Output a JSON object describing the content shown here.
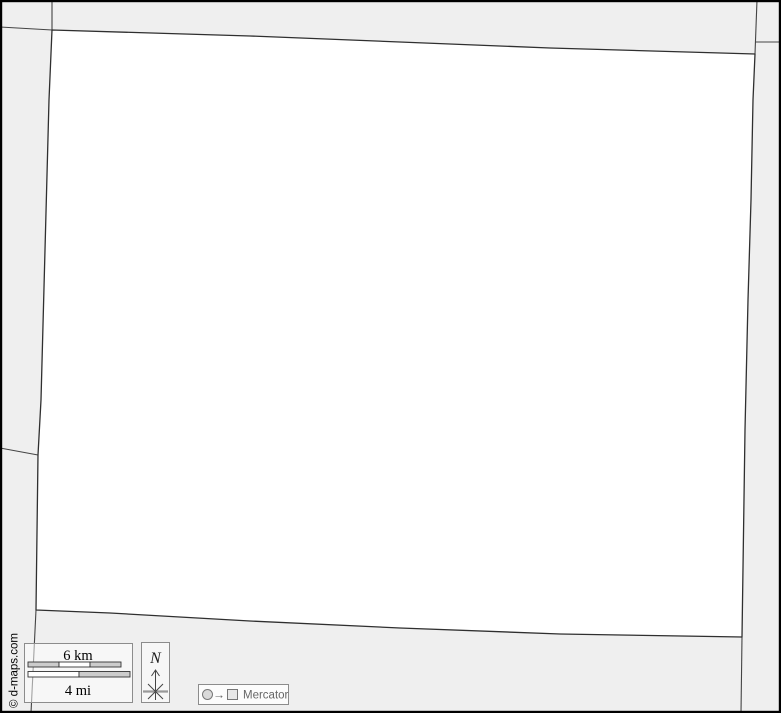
{
  "map": {
    "copyright": "© d-maps.com",
    "scale_bar": {
      "km_label": "6 km",
      "mi_label": "4 mi"
    },
    "compass": {
      "north_label": "N"
    },
    "projection": {
      "label": "Mercator",
      "arrow_glyph": "→"
    },
    "icons": {
      "north_arrow": "compass-star-arrow",
      "projection_source": "circle",
      "projection_target": "square"
    },
    "colors": {
      "background": "#efefef",
      "territory_fill": "#ffffff",
      "territory_border": "#2f2f2f",
      "neighbor_border": "#444444",
      "frame": "#000000",
      "legend_box_border": "#8c8c8c",
      "scale_bar_fill": "#cccccc",
      "projection_text": "#666666"
    }
  }
}
